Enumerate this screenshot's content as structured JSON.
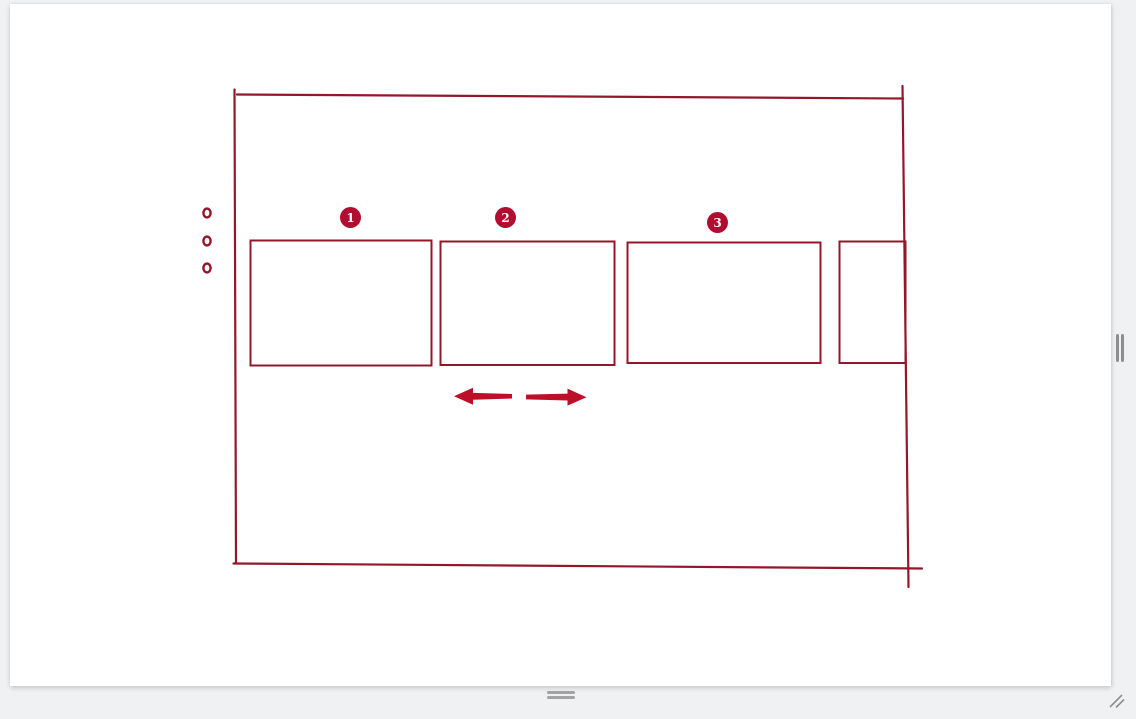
{
  "page": {
    "background_color": "#f0f1f2",
    "canvas_background": "#ffffff"
  },
  "sketch": {
    "stroke_color": "#93172a",
    "badge_color": "#b20d30",
    "arrow_color": "#bd0f27",
    "badges": [
      {
        "label": "1"
      },
      {
        "label": "2"
      },
      {
        "label": "3"
      }
    ],
    "bullet_count": 3,
    "arrows": [
      {
        "direction": "left"
      },
      {
        "direction": "right"
      }
    ]
  },
  "handles": {
    "right_panel_handle_icon": "vertical-grip",
    "bottom_panel_handle_icon": "horizontal-grip",
    "corner_grip_icon": "diagonal-resize-grip"
  }
}
